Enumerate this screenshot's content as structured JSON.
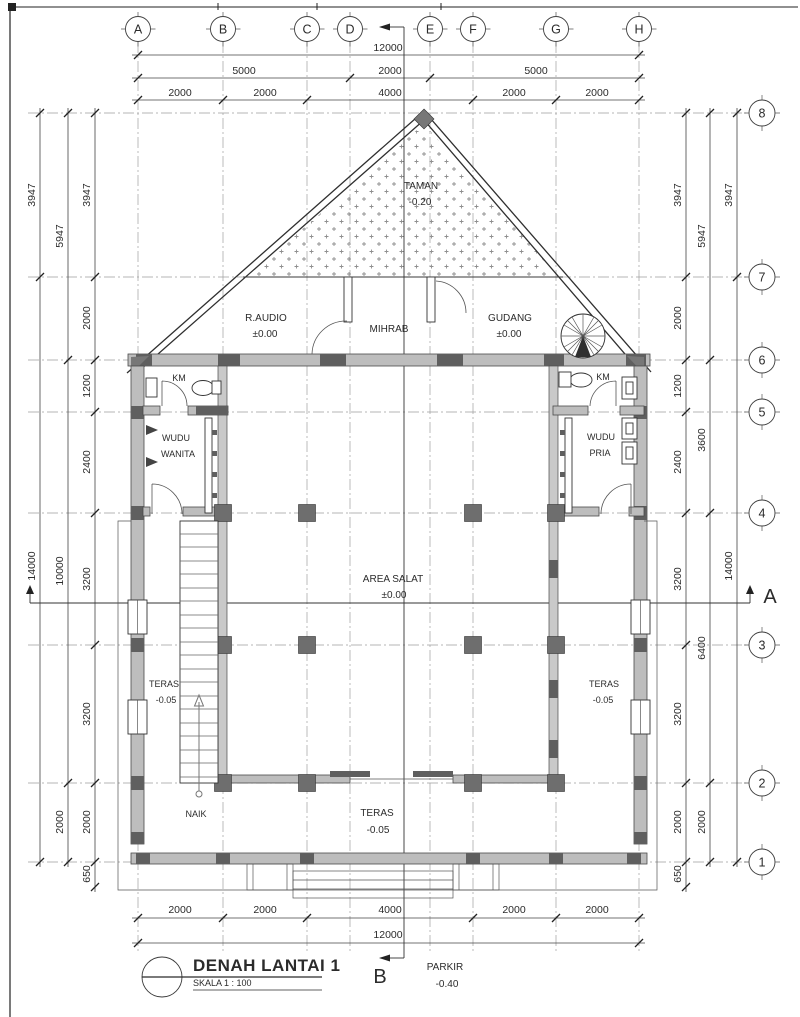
{
  "titleblock": {
    "title": "DENAH LANTAI 1",
    "scale": "SKALA 1 : 100"
  },
  "sections": {
    "a": "A",
    "b": "B"
  },
  "grid": {
    "columns": [
      "A",
      "B",
      "C",
      "D",
      "E",
      "F",
      "G",
      "H"
    ],
    "rows": [
      "8",
      "7",
      "6",
      "5",
      "4",
      "3",
      "2",
      "1"
    ]
  },
  "dims": {
    "top_total": "12000",
    "top_mid": [
      "5000",
      "2000",
      "5000"
    ],
    "top_inner": [
      "2000",
      "2000",
      "4000",
      "2000",
      "2000"
    ],
    "bottom_inner": [
      "2000",
      "2000",
      "4000",
      "2000",
      "2000"
    ],
    "bottom_total": "12000",
    "left_inner": [
      "3947",
      "2000",
      "1200",
      "2400",
      "3200",
      "3200",
      "2000",
      "650"
    ],
    "left_middle": [
      "5947",
      "10000",
      "2000"
    ],
    "left_outer": [
      "3947",
      "14000"
    ],
    "right_inner": [
      "3947",
      "2000",
      "1200",
      "2400",
      "3200",
      "3200",
      "2000",
      "650"
    ],
    "right_middle": [
      "5947",
      "3600",
      "6400",
      "2000"
    ],
    "right_outer": [
      "3947",
      "14000"
    ]
  },
  "rooms": {
    "taman": {
      "name": "TAMAN",
      "level": "-0.20"
    },
    "r_audio": {
      "name": "R.AUDIO",
      "level": "±0.00"
    },
    "mihrab": {
      "name": "MIHRAB"
    },
    "gudang": {
      "name": "GUDANG",
      "level": "±0.00"
    },
    "km_left": {
      "name": "KM"
    },
    "km_right": {
      "name": "KM"
    },
    "wudu_wanita": {
      "line1": "WUDU",
      "line2": "WANITA"
    },
    "wudu_pria": {
      "line1": "WUDU",
      "line2": "PRIA"
    },
    "area_salat": {
      "name": "AREA SALAT",
      "level": "±0.00"
    },
    "teras_left": {
      "name": "TERAS",
      "level": "-0.05"
    },
    "teras_right": {
      "name": "TERAS",
      "level": "-0.05"
    },
    "teras_bottom": {
      "name": "TERAS",
      "level": "-0.05"
    },
    "stairs": {
      "label": "NAIK"
    },
    "parkir": {
      "name": "PARKIR",
      "level": "-0.40"
    }
  }
}
